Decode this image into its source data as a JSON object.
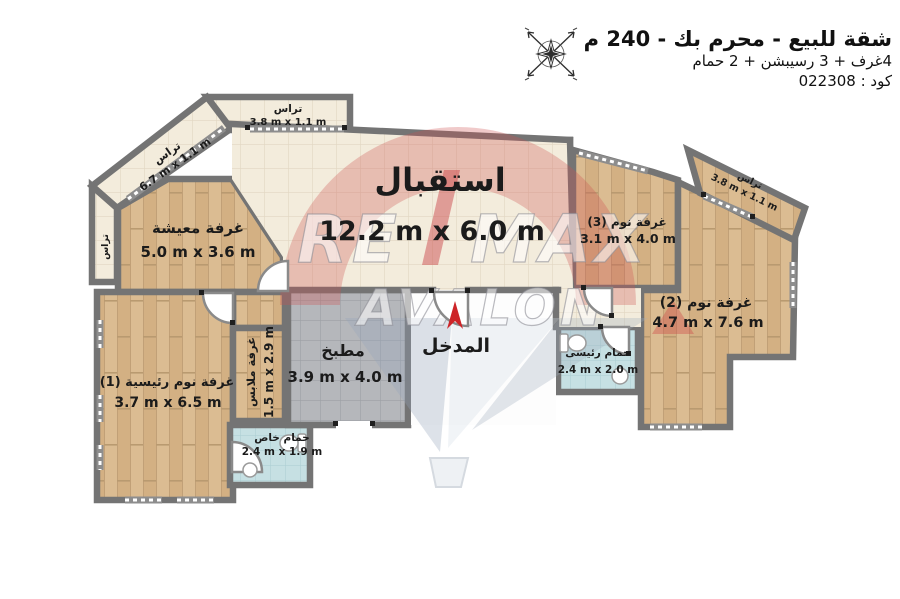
{
  "header": {
    "title": "شقة للبيع - محرم بك - 240 م",
    "subtitle": "4غرف + 3 رسيبشن + 2 حمام",
    "code_line": "كود : 022308"
  },
  "watermark": {
    "re": "RE",
    "max": "MAX",
    "avalon": "AVALON"
  },
  "rooms": {
    "reception": {
      "name": "استقبال",
      "dims": "12.2 m x 6.0 m"
    },
    "living": {
      "name": "غرفة معيشة",
      "dims": "5.0 m x 3.6 m"
    },
    "master_bedroom": {
      "name": "غرفة نوم رئيسية (1)",
      "dims": "3.7 m x 6.5 m"
    },
    "bedroom2": {
      "name": "غرفة نوم (2)",
      "dims": "4.7 m x 7.6 m"
    },
    "bedroom3": {
      "name": "غرفة نوم (3)",
      "dims": "3.1 m x 4.0 m"
    },
    "kitchen": {
      "name": "مطبخ",
      "dims": "3.9 m x 4.0 m"
    },
    "dressing": {
      "name": "غرفة ملابس",
      "dims": "1.5 m x 2.9 m"
    },
    "private_bath": {
      "name": "حمام خاص",
      "dims": "2.4 m x 1.9 m"
    },
    "master_bath": {
      "name": "حمام رئيسى",
      "dims": "2.4 m x 2.0 m"
    },
    "entrance": {
      "name": "المدخل"
    },
    "terrace_top": {
      "name": "تراس",
      "dims": "3.8 m x 1.1 m"
    },
    "terrace_diagonal": {
      "name": "تراس",
      "dims": "6.7 m x 1.1 m"
    },
    "terrace_right": {
      "name": "تراس",
      "dims": "3.8 m x 1.1 m"
    },
    "terrace_left": {
      "name": "تراس"
    }
  },
  "colors": {
    "accent_red": "#cd2428",
    "wall_gray": "#747474",
    "wood": "#dbbc92",
    "tile_cream": "#f3ecdc",
    "tile_blue": "#c6e0e3",
    "tile_gray": "#b5b7bb"
  }
}
